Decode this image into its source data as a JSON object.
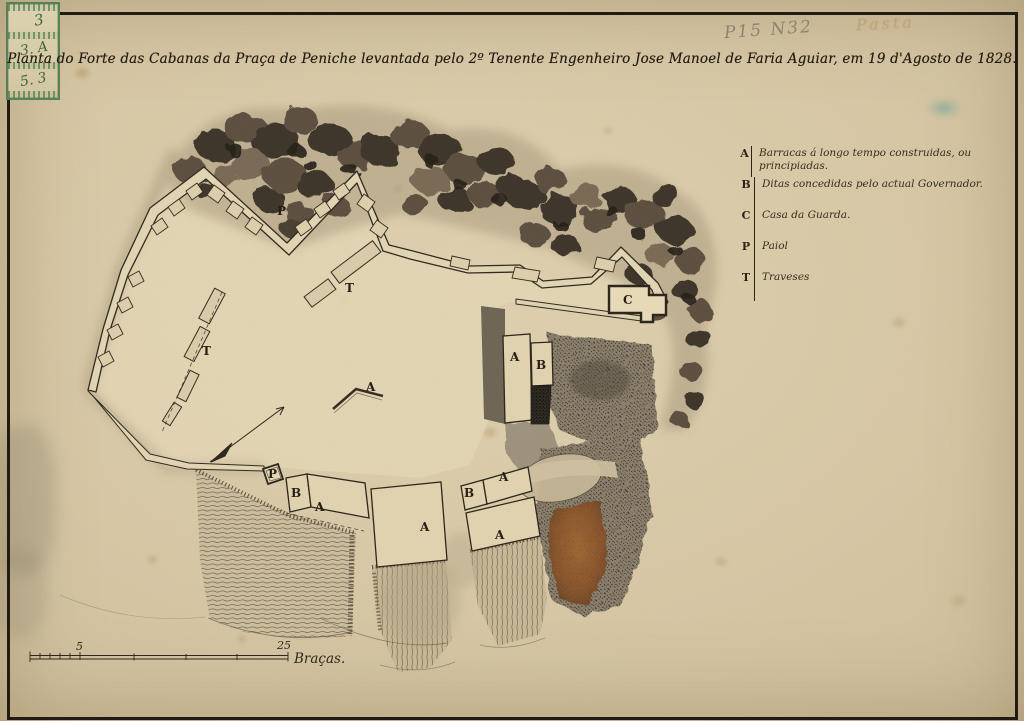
{
  "page": {
    "paper_color": "#d8c8a6",
    "ink_color": "#241d12",
    "stamp_color": "#3f7346"
  },
  "title": {
    "text": "Planta do Forte das Cabanas da Praça de Peniche levantada pelo 2º Tenente Engenheiro Jose Manoel de Faria Aguiar, em 19 d'Agosto de 1828."
  },
  "annotations": {
    "pencil": "P15 N32",
    "ink_faded": "Pasta",
    "stamp_lines": [
      "3",
      "3. A",
      "5. 3"
    ]
  },
  "legend": {
    "entries": [
      {
        "key": "A",
        "label": "Barracas á longo tempo construidas, ou principiadas."
      },
      {
        "key": "B",
        "label": "Ditas concedidas pelo actual Governador."
      },
      {
        "key": "C",
        "label": "Casa da Guarda."
      },
      {
        "key": "P",
        "label": "Paiol"
      },
      {
        "key": "T",
        "label": "Traveses"
      }
    ]
  },
  "scale_bar": {
    "labels": [
      {
        "text": "5",
        "x": 76,
        "y": 650
      },
      {
        "text": "25",
        "x": 277,
        "y": 649
      }
    ],
    "unit": "Braças."
  },
  "map_labels": [
    {
      "text": "P",
      "x": 277,
      "y": 215
    },
    {
      "text": "T",
      "x": 345,
      "y": 292
    },
    {
      "text": "T",
      "x": 202,
      "y": 355
    },
    {
      "text": "A",
      "x": 366,
      "y": 391
    },
    {
      "text": "A",
      "x": 510,
      "y": 361
    },
    {
      "text": "B",
      "x": 536,
      "y": 369
    },
    {
      "text": "C",
      "x": 623,
      "y": 304
    },
    {
      "text": "P",
      "x": 268,
      "y": 478
    },
    {
      "text": "B",
      "x": 291,
      "y": 497
    },
    {
      "text": "A",
      "x": 315,
      "y": 511
    },
    {
      "text": "A",
      "x": 420,
      "y": 531
    },
    {
      "text": "B",
      "x": 464,
      "y": 497
    },
    {
      "text": "A",
      "x": 499,
      "y": 481
    },
    {
      "text": "A",
      "x": 495,
      "y": 539
    }
  ]
}
